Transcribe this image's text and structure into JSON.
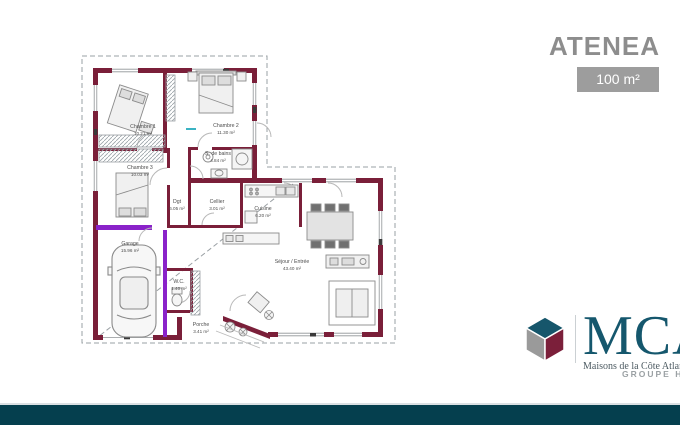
{
  "header": {
    "title": "ATENEA",
    "area_badge": "100 m²"
  },
  "plan": {
    "rooms": [
      {
        "name": "Chambre 1",
        "area": "10.21 m²"
      },
      {
        "name": "Chambre 2",
        "area": "11.30 m²"
      },
      {
        "name": "Chambre 3",
        "area": "10.03 m²"
      },
      {
        "name": "S. de bains",
        "area": "4.84 m²"
      },
      {
        "name": "Dgt",
        "area": "6.05 m²"
      },
      {
        "name": "Cellier",
        "area": "3.01 m²"
      },
      {
        "name": "Cuisine",
        "area": "6.20 m²"
      },
      {
        "name": "Garage",
        "area": "15.96 m²"
      },
      {
        "name": "W.C.",
        "area": "1.40 m²"
      },
      {
        "name": "Séjour / Entrée",
        "area": "43.40 m²"
      },
      {
        "name": "Porche",
        "area": "3.41 m²"
      }
    ]
  },
  "branding": {
    "name": "MCA",
    "tagline": "Maisons de la Côte Atlantique",
    "group": "GROUPE HEXAOM"
  },
  "colors": {
    "wall_burgundy": "#7a1f39",
    "accent_purple": "#8a22c9",
    "brand_teal": "#15576d",
    "title_gray": "#8d8d8d",
    "badge_gray": "#9d9d9d",
    "footer_bar": "#053f4e",
    "dimension_cyan": "#3bb3c3"
  }
}
